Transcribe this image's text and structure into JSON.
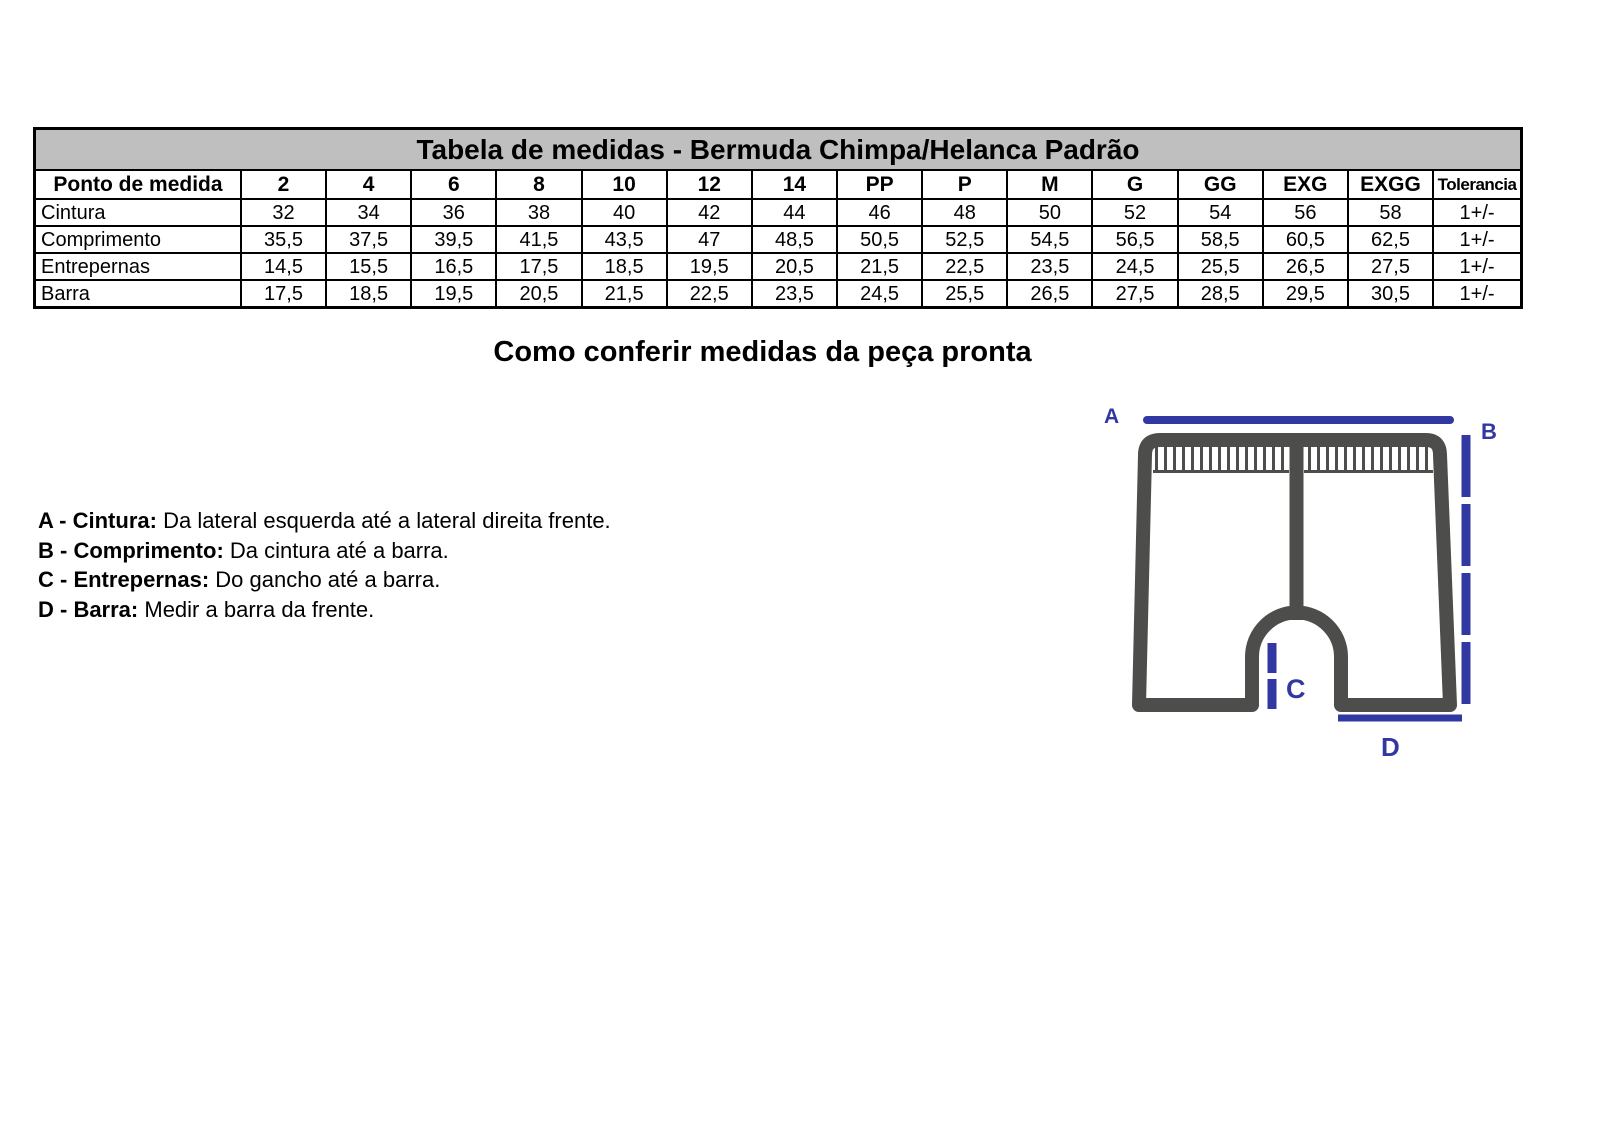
{
  "colors": {
    "accent": "#3238a2",
    "outline": "#4d4d4b",
    "title-bg": "#bfbfbf"
  },
  "table": {
    "title": "Tabela de medidas - Bermuda Chimpa/Helanca Padrão",
    "columns": [
      "Ponto de medida",
      "2",
      "4",
      "6",
      "8",
      "10",
      "12",
      "14",
      "PP",
      "P",
      "M",
      "G",
      "GG",
      "EXG",
      "EXGG",
      "Tolerancia"
    ],
    "rows": [
      {
        "label": "Cintura",
        "values": [
          "32",
          "34",
          "36",
          "38",
          "40",
          "42",
          "44",
          "46",
          "48",
          "50",
          "52",
          "54",
          "56",
          "58",
          "1+/-"
        ]
      },
      {
        "label": "Comprimento",
        "values": [
          "35,5",
          "37,5",
          "39,5",
          "41,5",
          "43,5",
          "47",
          "48,5",
          "50,5",
          "52,5",
          "54,5",
          "56,5",
          "58,5",
          "60,5",
          "62,5",
          "1+/-"
        ]
      },
      {
        "label": "Entrepernas",
        "values": [
          "14,5",
          "15,5",
          "16,5",
          "17,5",
          "18,5",
          "19,5",
          "20,5",
          "21,5",
          "22,5",
          "23,5",
          "24,5",
          "25,5",
          "26,5",
          "27,5",
          "1+/-"
        ]
      },
      {
        "label": "Barra",
        "values": [
          "17,5",
          "18,5",
          "19,5",
          "20,5",
          "21,5",
          "22,5",
          "23,5",
          "24,5",
          "25,5",
          "26,5",
          "27,5",
          "28,5",
          "29,5",
          "30,5",
          "1+/-"
        ]
      }
    ]
  },
  "section_heading": "Como conferir medidas da peça pronta",
  "legend": [
    {
      "term": "A - Cintura:",
      "description": "Da lateral esquerda até a lateral direita frente."
    },
    {
      "term": "B - Comprimento:",
      "description": "Da cintura até a barra."
    },
    {
      "term": "C - Entrepernas:",
      "description": "Do gancho até a barra."
    },
    {
      "term": "D - Barra:",
      "description": "Medir a barra da frente."
    }
  ],
  "diagram": {
    "labels": {
      "a": "A",
      "b": "B",
      "c": "C",
      "d": "D"
    }
  }
}
